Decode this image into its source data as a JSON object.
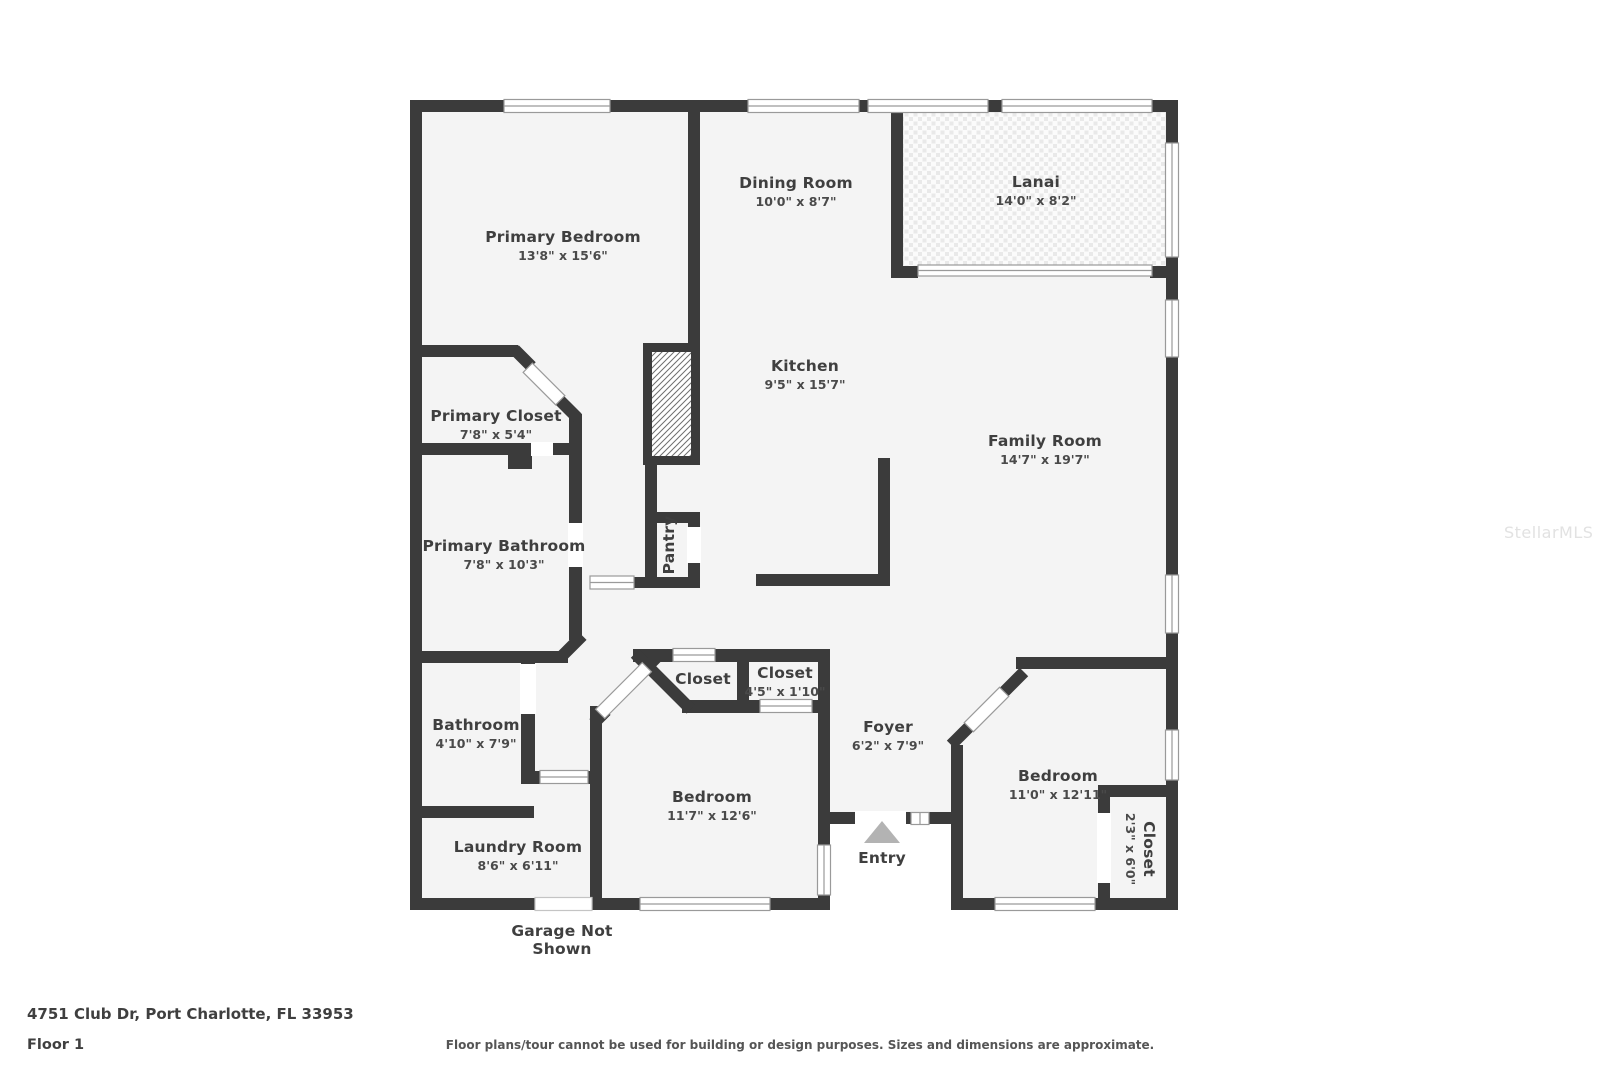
{
  "watermark": "StellarMLS",
  "footer": {
    "address_line": "4751 Club Dr, Port Charlotte, FL 33953",
    "floor_label": "Floor 1",
    "disclaimer": "Floor plans/tour cannot be used for building or design purposes. Sizes and dimensions are approximate."
  },
  "garage_note": {
    "line1": "Garage Not",
    "line2": "Shown"
  },
  "entry": {
    "label": "Entry"
  },
  "rooms": {
    "primary_bedroom": {
      "name": "Primary Bedroom",
      "dims": "13'8\" x 15'6\""
    },
    "dining_room": {
      "name": "Dining Room",
      "dims": "10'0\" x 8'7\""
    },
    "lanai": {
      "name": "Lanai",
      "dims": "14'0\" x 8'2\""
    },
    "kitchen": {
      "name": "Kitchen",
      "dims": "9'5\" x 15'7\""
    },
    "family_room": {
      "name": "Family Room",
      "dims": "14'7\" x 19'7\""
    },
    "primary_closet": {
      "name": "Primary Closet",
      "dims": "7'8\" x 5'4\""
    },
    "primary_bathroom": {
      "name": "Primary Bathroom",
      "dims": "7'8\" x 10'3\""
    },
    "pantry": {
      "name": "Pantry"
    },
    "bathroom": {
      "name": "Bathroom",
      "dims": "4'10\" x 7'9\""
    },
    "laundry_room": {
      "name": "Laundry Room",
      "dims": "8'6\" x 6'11\""
    },
    "bedroom_mid": {
      "name": "Bedroom",
      "dims": "11'7\" x 12'6\""
    },
    "closet_angled": {
      "name": "Closet"
    },
    "closet_hall": {
      "name": "Closet",
      "dims": "4'5\" x 1'10\""
    },
    "foyer": {
      "name": "Foyer",
      "dims": "6'2\" x 7'9\""
    },
    "bedroom_right": {
      "name": "Bedroom",
      "dims": "11'0\" x 12'11\""
    },
    "closet_right": {
      "name": "Closet",
      "dims": "2'3\" x 6'0\""
    }
  },
  "colors": {
    "wall": "#3b3b3b",
    "floor": "#f4f4f4",
    "window_line": "#9a9a9a",
    "entry_arrow": "#b3b3b3",
    "text": "#3f3f3f"
  }
}
